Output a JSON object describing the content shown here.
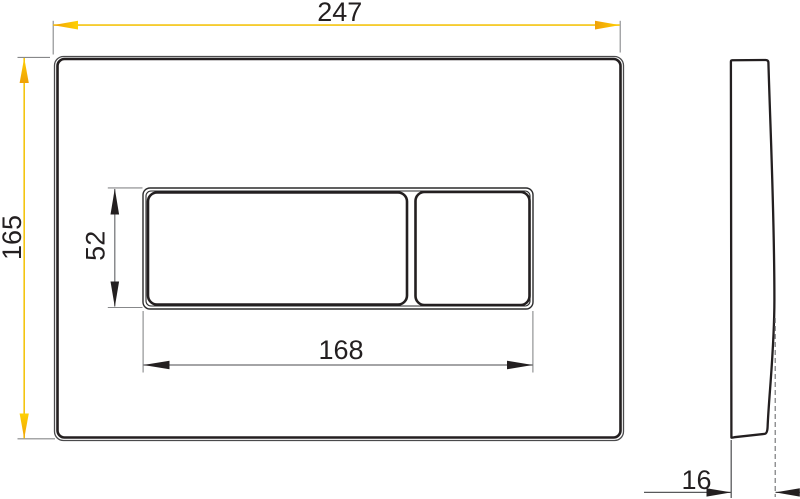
{
  "drawing": {
    "views": {
      "front": {
        "dimensions": {
          "overall_width": "247",
          "overall_height": "165",
          "button_area_width": "168",
          "button_area_height": "52"
        }
      },
      "side": {
        "dimensions": {
          "depth": "16"
        }
      }
    },
    "colors": {
      "dimension_highlight_line": "#F4C410",
      "dimension_arrow_orange": "#EFA007",
      "dimension_arrow_yellow": "#FFD103",
      "outline": "#231F20",
      "dimension_line_gray": "#6D6E71",
      "background": "#FFFFFF"
    }
  }
}
